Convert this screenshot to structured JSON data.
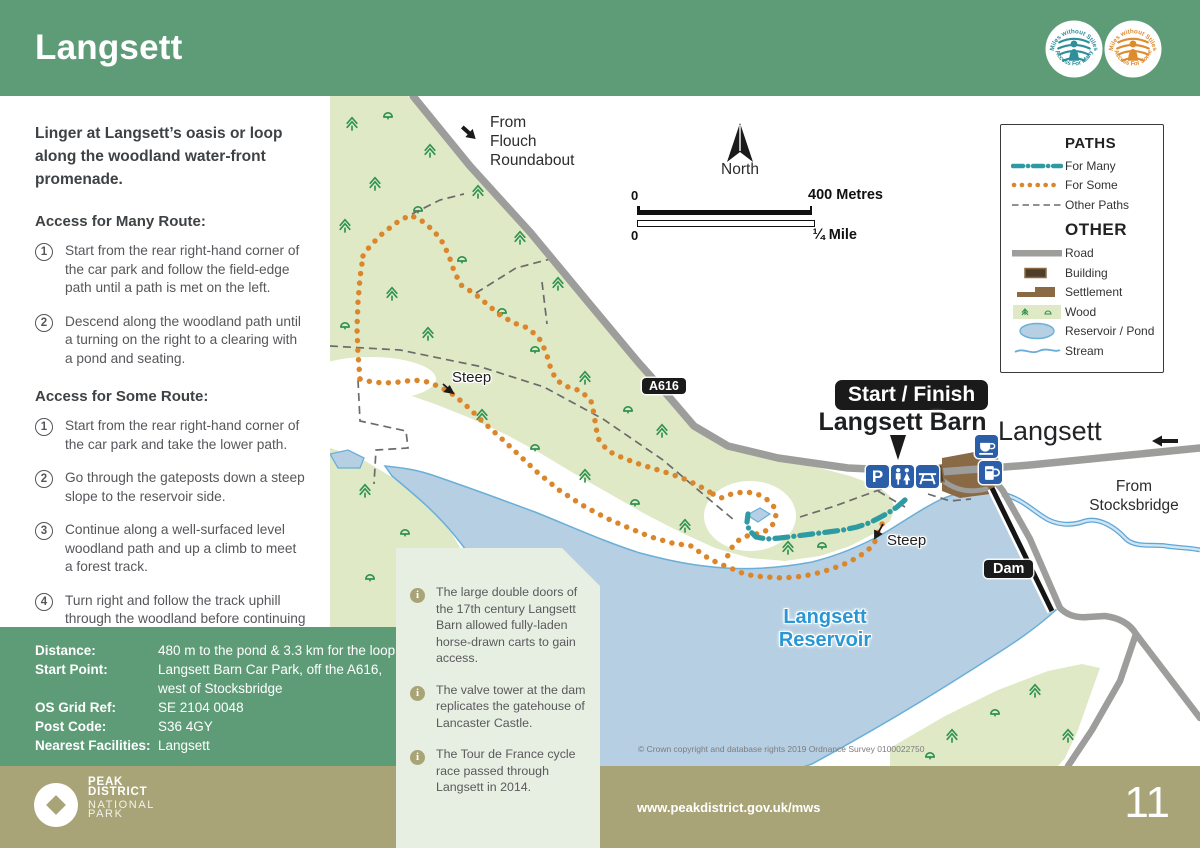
{
  "header": {
    "title": "Langsett",
    "badges": [
      {
        "top": "Miles without Stiles",
        "bottom": "Access For Many",
        "color": "#2E8F9B"
      },
      {
        "top": "Miles without Stiles",
        "bottom": "Access For Some",
        "color": "#DE8B2D"
      }
    ]
  },
  "sidebar": {
    "intro": "Linger at Langsett’s oasis or loop along the woodland water-front promenade.",
    "sections": [
      {
        "heading": "Access for Many Route:",
        "steps": [
          {
            "n": "1",
            "text": "Start from the rear right-hand corner of the car park and follow the field-edge path until a path is met on the left."
          },
          {
            "n": "2",
            "text": "Descend along the woodland path until a turning on the right to a clearing with a pond and seating."
          }
        ]
      },
      {
        "heading": "Access for Some Route:",
        "steps": [
          {
            "n": "1",
            "text": "Start from the rear right-hand corner of the car park and take the lower path."
          },
          {
            "n": "2",
            "text": "Go through the gateposts down a steep slope to the reservoir side."
          },
          {
            "n": "3",
            "text": "Continue along a well-surfaced level woodland path and up a climb to meet a forest track."
          },
          {
            "n": "4",
            "text": "Turn right and follow the track uphill through the woodland before continuing parallel to, but at some distance from, the main road before meeting the field-edge path back to the car park."
          }
        ]
      }
    ]
  },
  "details": {
    "rows": [
      {
        "label": "Distance:",
        "value": "480 m to the pond & 3.3 km for the loop"
      },
      {
        "label": "Start Point:",
        "value": "Langsett Barn Car Park, off the A616, west of Stocksbridge"
      },
      {
        "label": "OS Grid Ref:",
        "value": "SE 2104 0048"
      },
      {
        "label": "Post Code:",
        "value": "S36 4GY"
      },
      {
        "label": "Nearest Facilities:",
        "value": "Langsett"
      }
    ]
  },
  "legend": {
    "paths_title": "PATHS",
    "other_title": "OTHER",
    "paths_items": [
      "For Many",
      "For Some",
      "Other Paths"
    ],
    "other_items": [
      "Road",
      "Building",
      "Settlement",
      "Wood",
      "Reservoir / Pond",
      "Stream"
    ]
  },
  "map": {
    "labels": {
      "from_flouch": [
        "From",
        "Flouch",
        "Roundabout"
      ],
      "north": "North",
      "scale_m0": "0",
      "scale_m": "400 Metres",
      "scale_mi0": "0",
      "scale_mi": "¼ Mile",
      "a616": "A616",
      "start_finish": "Start / Finish",
      "langsett_barn": "Langsett Barn",
      "langsett": "Langsett",
      "from_stocksbridge": [
        "From",
        "Stocksbridge"
      ],
      "steep_west": "Steep",
      "steep_east": "Steep",
      "dam": "Dam",
      "reservoir": [
        "Langsett",
        "Reservoir"
      ],
      "copyright": "© Crown copyright and database rights 2019  Ordnance Survey 0100022750"
    },
    "callout_items": [
      "The large double doors of the 17th century Langsett Barn allowed fully-laden horse-drawn carts to gain access.",
      "The valve tower at the dam replicates the gatehouse of Lancaster Castle.",
      "The Tour de France cycle race passed through Langsett in 2014."
    ]
  },
  "footer": {
    "url": "www.peakdistrict.gov.uk/mws",
    "page": "11",
    "logo": {
      "line1": "PEAK",
      "line2": "DISTRICT",
      "line3": "NATIONAL",
      "line4": "PARK"
    }
  },
  "colors": {
    "header_green": "#5E9C78",
    "footer_olive": "#A9A478",
    "callout_sage": "#E7EEE2",
    "wood_green": "#DFE9C6",
    "tree_green": "#2E9150",
    "water_blue": "#B6CFE2",
    "water_edge": "#69AFD8",
    "road_grey": "#9D9D9C",
    "route_for_some_orange": "#DC862C",
    "route_for_many_teal": "#2E9BA2",
    "other_path_grey": "#6B6B6B",
    "settlement_brown": "#8A6A44",
    "building_brown": "#4F3D2C",
    "facility_icon_blue": "#2B5EA8",
    "reservoir_label_blue": "#2A97D4"
  }
}
